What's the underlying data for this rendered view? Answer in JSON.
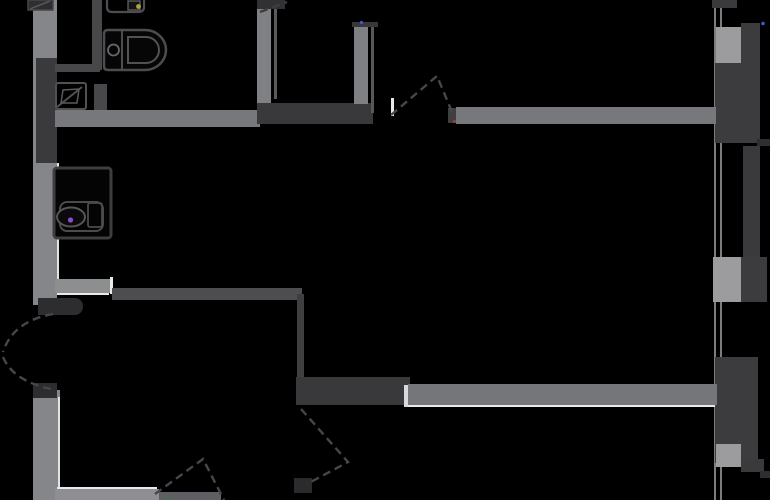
{
  "meta": {
    "type": "architectural-floor-plan",
    "description": "apartment floor plan, gray walls on black background, no text labels",
    "background_color": "#000000",
    "wall_color_light": "#85868a",
    "wall_color_dark": "#3a3a3c",
    "highlight_color": "#e9e9ea",
    "door_swing_color": "#47474a"
  },
  "canvas": {
    "width": 770,
    "height": 500
  },
  "rects": [
    {
      "name": "window-glazing-line-outer",
      "x": 714,
      "y": 0,
      "w": 2,
      "h": 500,
      "color": "#7b7c7e"
    },
    {
      "name": "window-glazing-line-inner",
      "x": 720,
      "y": 0,
      "w": 2,
      "h": 500,
      "color": "#7b7c7e"
    },
    {
      "name": "facade-wall-top",
      "x": 712,
      "y": 0,
      "w": 25,
      "h": 8,
      "color": "#3a3a3c"
    },
    {
      "name": "facade-strip-upper-right",
      "x": 741,
      "y": 23,
      "w": 19,
      "h": 44,
      "color": "#3c3c3e"
    },
    {
      "name": "facade-pier-top",
      "x": 716,
      "y": 27,
      "w": 25,
      "h": 38,
      "color": "#9c9c9e"
    },
    {
      "name": "facade-wall-upper",
      "x": 715,
      "y": 63,
      "w": 45,
      "h": 80,
      "color": "#3c3c3e"
    },
    {
      "name": "facade-strip-mid",
      "x": 743,
      "y": 146,
      "w": 17,
      "h": 112,
      "color": "#3a3a3c"
    },
    {
      "name": "facade-pier-mid",
      "x": 713,
      "y": 257,
      "w": 28,
      "h": 45,
      "color": "#9c9c9e"
    },
    {
      "name": "facade-wall-mid-right",
      "x": 741,
      "y": 257,
      "w": 26,
      "h": 45,
      "color": "#3c3c3e"
    },
    {
      "name": "facade-wall-lower",
      "x": 715,
      "y": 357,
      "w": 43,
      "h": 106,
      "color": "#3c3c3e"
    },
    {
      "name": "facade-pier-bottom",
      "x": 716,
      "y": 444,
      "w": 25,
      "h": 23,
      "color": "#9c9c9e"
    },
    {
      "name": "facade-stub-bottom-right",
      "x": 741,
      "y": 459,
      "w": 23,
      "h": 13,
      "color": "#3a3a3c"
    },
    {
      "name": "facade-slab-tick-top",
      "x": 757,
      "y": 139,
      "w": 13,
      "h": 7,
      "color": "#2e2e30"
    },
    {
      "name": "facade-slab-tick-bottom",
      "x": 760,
      "y": 471,
      "w": 10,
      "h": 7,
      "color": "#2e2e30"
    },
    {
      "name": "left-exterior-wall-upper",
      "x": 33,
      "y": 0,
      "w": 24,
      "h": 305,
      "color": "#85868a"
    },
    {
      "name": "left-wall-shaft-dark",
      "x": 36,
      "y": 58,
      "w": 21,
      "h": 105,
      "color": "#3a3a3c"
    },
    {
      "name": "left-wall-highlight-upper",
      "x": 57,
      "y": 163,
      "w": 2,
      "h": 116,
      "color": "#e3e3e4"
    },
    {
      "name": "entry-door-jamb-top",
      "x": 38,
      "y": 298,
      "w": 45,
      "h": 17,
      "color": "#2d2d2f",
      "radius": "0 8px 8px 0"
    },
    {
      "name": "left-exterior-wall-lower",
      "x": 33,
      "y": 390,
      "w": 27,
      "h": 110,
      "color": "#85868a"
    },
    {
      "name": "entry-door-jamb-bottom",
      "x": 33,
      "y": 383,
      "w": 24,
      "h": 15,
      "color": "#2d2d2f"
    },
    {
      "name": "left-wall-highlight-lower",
      "x": 58,
      "y": 397,
      "w": 2,
      "h": 103,
      "color": "#e3e3e4"
    },
    {
      "name": "bathroom-partition-vertical",
      "x": 92,
      "y": 0,
      "w": 10,
      "h": 70,
      "color": "#48484b"
    },
    {
      "name": "bathroom-partition-horizontal",
      "x": 55,
      "y": 64,
      "w": 45,
      "h": 8,
      "color": "#48484b"
    },
    {
      "name": "bathroom-partition-lower",
      "x": 94,
      "y": 84,
      "w": 13,
      "h": 26,
      "color": "#48484b"
    },
    {
      "name": "bathroom-right-wall",
      "x": 257,
      "y": 6,
      "w": 14,
      "h": 98,
      "color": "#7f8083"
    },
    {
      "name": "bathroom-right-wall-thin-line",
      "x": 274,
      "y": 0,
      "w": 3,
      "h": 99,
      "color": "#5a5a5d"
    },
    {
      "name": "bathroom-bottom-wall",
      "x": 55,
      "y": 110,
      "w": 205,
      "h": 17,
      "color": "#77787b"
    },
    {
      "name": "closet-dark-block",
      "x": 257,
      "y": 103,
      "w": 116,
      "h": 21,
      "color": "#39393b"
    },
    {
      "name": "interior-door-right-jamb",
      "x": 448,
      "y": 108,
      "w": 10,
      "h": 15,
      "color": "#3f3f42"
    },
    {
      "name": "upper-wall-right-of-door",
      "x": 456,
      "y": 107,
      "w": 260,
      "h": 17,
      "color": "#77787b"
    },
    {
      "name": "door-leaf-highlight-tick",
      "x": 391,
      "y": 98,
      "w": 3,
      "h": 18,
      "color": "#e8e8e9"
    },
    {
      "name": "top-niche-right-wall",
      "x": 354,
      "y": 24,
      "w": 14,
      "h": 80,
      "color": "#7f8083"
    },
    {
      "name": "top-niche-wall-cap",
      "x": 352,
      "y": 22,
      "w": 26,
      "h": 5,
      "color": "#38383a"
    },
    {
      "name": "top-niche-thin-line",
      "x": 371,
      "y": 27,
      "w": 3,
      "h": 86,
      "color": "#58585b"
    },
    {
      "name": "top-edge-wall-mark",
      "x": 257,
      "y": 0,
      "w": 28,
      "h": 9,
      "color": "#313133"
    },
    {
      "name": "mid-wall-bright-segment",
      "x": 55,
      "y": 279,
      "w": 58,
      "h": 14,
      "color": "#8d8e90"
    },
    {
      "name": "mid-wall-highlight-under",
      "x": 57,
      "y": 293,
      "w": 52,
      "h": 2,
      "color": "#e9e9ea"
    },
    {
      "name": "mid-wall-highlight-tick",
      "x": 110,
      "y": 277,
      "w": 3,
      "h": 17,
      "color": "#e9e9ea"
    },
    {
      "name": "mid-wall-dark-segment",
      "x": 112,
      "y": 288,
      "w": 190,
      "h": 12,
      "color": "#4d4d50"
    },
    {
      "name": "mid-vertical-wall",
      "x": 297,
      "y": 294,
      "w": 7,
      "h": 84,
      "color": "#3f3f42"
    },
    {
      "name": "wardrobe-dark-block",
      "x": 296,
      "y": 377,
      "w": 114,
      "h": 28,
      "color": "#39393b"
    },
    {
      "name": "lower-wall-highlight-tick",
      "x": 404,
      "y": 385,
      "w": 4,
      "h": 22,
      "color": "#d9d9db"
    },
    {
      "name": "lower-right-wall",
      "x": 408,
      "y": 384,
      "w": 309,
      "h": 21,
      "color": "#75767a"
    },
    {
      "name": "lower-wall-highlight-line",
      "x": 408,
      "y": 405,
      "w": 307,
      "h": 2,
      "color": "#e9e9ea"
    },
    {
      "name": "bottom-wall-bright-segment",
      "x": 55,
      "y": 489,
      "w": 104,
      "h": 11,
      "color": "#8e8f92"
    },
    {
      "name": "bottom-wall-highlight-line",
      "x": 57,
      "y": 487,
      "w": 100,
      "h": 2,
      "color": "#e9e9ea"
    },
    {
      "name": "bottom-wall-dim-segment",
      "x": 159,
      "y": 492,
      "w": 62,
      "h": 8,
      "color": "#5e5f62"
    },
    {
      "name": "bottom-door-jamb-block",
      "x": 294,
      "y": 478,
      "w": 18,
      "h": 15,
      "color": "#2b2b2d"
    }
  ],
  "svg_elements": [
    {
      "name": "toilet-outline",
      "tag": "path",
      "attrs": {
        "d": "M108,30 H145 A21,20 0 0 1 145,70 H108 Q104,70 104,66 V34 Q104,30 108,30 Z",
        "stroke": "#4d4d4f",
        "stroke-width": "2.5",
        "fill": "#060607"
      }
    },
    {
      "name": "toilet-tank-divider",
      "tag": "path",
      "attrs": {
        "d": "M122,31 V69",
        "stroke": "#4d4d4f",
        "stroke-width": "2",
        "fill": "none"
      }
    },
    {
      "name": "toilet-flush-button",
      "tag": "circle",
      "attrs": {
        "cx": "113.5",
        "cy": "50",
        "r": "5.5",
        "stroke": "#68686a",
        "stroke-width": "1.8",
        "fill": "none"
      }
    },
    {
      "name": "toilet-bowl",
      "tag": "path",
      "attrs": {
        "d": "M128,37 H146 A13,13 0 0 1 146,63 H128 Z",
        "stroke": "#525254",
        "stroke-width": "2",
        "fill": "none"
      }
    },
    {
      "name": "washbasin-top-outline",
      "tag": "path",
      "attrs": {
        "d": "M107,0 V7 Q107,12 112,12 H138 Q144,12 144,7 V0",
        "stroke": "#4d4d4f",
        "stroke-width": "2.2",
        "fill": "none"
      }
    },
    {
      "name": "washbasin-top-bowl",
      "tag": "rect",
      "attrs": {
        "x": "128",
        "y": "1",
        "width": "12",
        "height": "9",
        "stroke": "#565658",
        "stroke-width": "1.5",
        "fill": "#141415"
      }
    },
    {
      "name": "faucet-marker-yellow",
      "tag": "circle",
      "attrs": {
        "cx": "138.5",
        "cy": "6.5",
        "r": "2.4",
        "fill": "#b2a23c"
      }
    },
    {
      "name": "corner-fixture-topleft",
      "tag": "rect",
      "attrs": {
        "x": "28",
        "y": "0",
        "width": "25",
        "height": "10",
        "fill": "#2e2e30",
        "stroke": "#47474a",
        "stroke-width": "1.5"
      }
    },
    {
      "name": "corner-fixture-line",
      "tag": "path",
      "attrs": {
        "d": "M30,9 L50,1",
        "stroke": "#565658",
        "stroke-width": "1.5",
        "fill": "none"
      }
    },
    {
      "name": "corner-basin-outline",
      "tag": "rect",
      "attrs": {
        "x": "56",
        "y": "83",
        "width": "30",
        "height": "26",
        "rx": "2",
        "stroke": "#515153",
        "stroke-width": "2",
        "fill": "none"
      }
    },
    {
      "name": "corner-basin-diagonal",
      "tag": "path",
      "attrs": {
        "d": "M57,107 L82,87",
        "stroke": "#515153",
        "stroke-width": "2",
        "fill": "none"
      }
    },
    {
      "name": "corner-basin-bowl",
      "tag": "path",
      "attrs": {
        "d": "M61,103 L63,90 L79,89 L77,103 Z",
        "stroke": "#5a5a5c",
        "stroke-width": "1.5",
        "fill": "none"
      }
    },
    {
      "name": "vanity-outline",
      "tag": "rect",
      "attrs": {
        "x": "54",
        "y": "168",
        "width": "57",
        "height": "70",
        "rx": "3",
        "stroke": "#3e3e40",
        "stroke-width": "3",
        "fill": "#040405"
      }
    },
    {
      "name": "vanity-inner",
      "tag": "rect",
      "attrs": {
        "x": "60",
        "y": "202",
        "width": "43",
        "height": "29",
        "rx": "7",
        "stroke": "#4b4b4d",
        "stroke-width": "2",
        "fill": "none"
      }
    },
    {
      "name": "vanity-basin-right",
      "tag": "rect",
      "attrs": {
        "x": "88",
        "y": "203",
        "width": "14",
        "height": "24",
        "rx": "2",
        "stroke": "#4b4b4d",
        "stroke-width": "1.8",
        "fill": "none"
      }
    },
    {
      "name": "vanity-bowl",
      "tag": "ellipse",
      "attrs": {
        "cx": "71",
        "cy": "217",
        "rx": "14",
        "ry": "9.5",
        "stroke": "#565658",
        "stroke-width": "2",
        "fill": "#0a0a0b"
      }
    },
    {
      "name": "faucet-marker-purple",
      "tag": "circle",
      "attrs": {
        "cx": "70.5",
        "cy": "220",
        "r": "2.6",
        "fill": "#8a4ecf"
      }
    },
    {
      "name": "entry-door-swing-top",
      "tag": "path",
      "attrs": {
        "d": "M53,314 Q13,321 3,352",
        "stroke": "#47474a",
        "stroke-width": "2.4",
        "stroke-dasharray": "8 5",
        "fill": "none"
      }
    },
    {
      "name": "entry-door-swing-bottom",
      "tag": "path",
      "attrs": {
        "d": "M51,389 Q13,381 3,357",
        "stroke": "#47474a",
        "stroke-width": "2.4",
        "stroke-dasharray": "8 5",
        "fill": "none"
      }
    },
    {
      "name": "interior-door-swing-top",
      "tag": "path",
      "attrs": {
        "d": "M391,115 L437,76 L452,112",
        "stroke": "#47474a",
        "stroke-width": "2.4",
        "stroke-dasharray": "8 5",
        "fill": "none"
      }
    },
    {
      "name": "bottom-door-swing-peak",
      "tag": "path",
      "attrs": {
        "d": "M155,494 L203,459 L224,500",
        "stroke": "#47474a",
        "stroke-width": "2.4",
        "stroke-dasharray": "8 5",
        "fill": "none"
      }
    },
    {
      "name": "wardrobe-door-swing",
      "tag": "path",
      "attrs": {
        "d": "M301,409 L348,462 L307,484",
        "stroke": "#47474a",
        "stroke-width": "2.4",
        "stroke-dasharray": "8 5",
        "fill": "none"
      }
    },
    {
      "name": "top-edge-door-swing",
      "tag": "path",
      "attrs": {
        "d": "M260,12 L287,2",
        "stroke": "#3d3d40",
        "stroke-width": "2.4",
        "stroke-dasharray": "8 5",
        "fill": "none"
      }
    },
    {
      "name": "speck-blue-niche",
      "tag": "circle",
      "attrs": {
        "cx": "361.5",
        "cy": "22.5",
        "r": "1.6",
        "fill": "#4058c8"
      }
    },
    {
      "name": "speck-blue-facade",
      "tag": "circle",
      "attrs": {
        "cx": "763",
        "cy": "23.5",
        "r": "1.8",
        "fill": "#4058c8"
      }
    },
    {
      "name": "speck-red-door",
      "tag": "circle",
      "attrs": {
        "cx": "454.5",
        "cy": "121.5",
        "r": "1.5",
        "fill": "#a04038"
      }
    },
    {
      "name": "speck-green-bottom",
      "tag": "circle",
      "attrs": {
        "cx": "166",
        "cy": "497",
        "r": "1.5",
        "fill": "#3f7a3f"
      }
    }
  ]
}
